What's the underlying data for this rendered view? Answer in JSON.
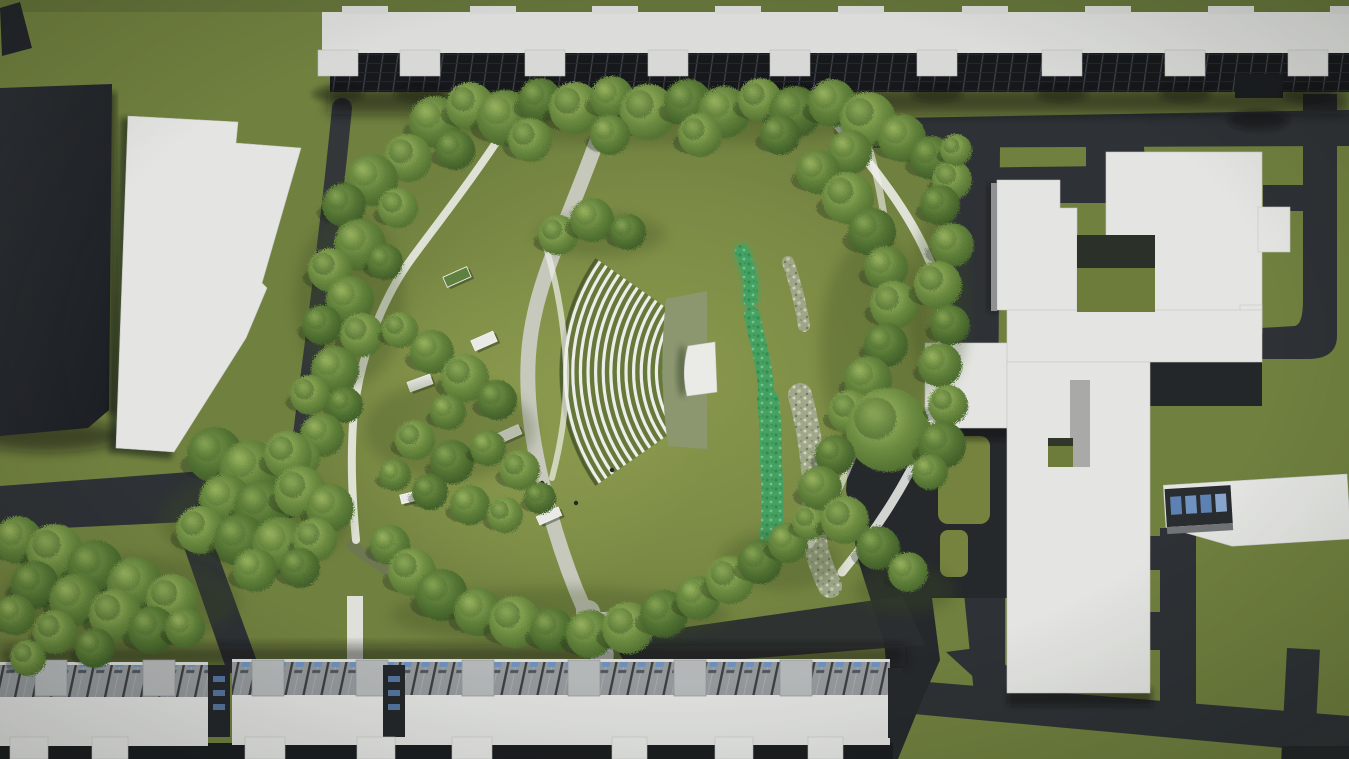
{
  "scene": {
    "title": "Aerial 3D architectural render of a park with amphitheater, winding paths, stream planting and surrounding apartment and school buildings",
    "type": "architectural-site-render",
    "canvas": {
      "width": 1349,
      "height": 759
    },
    "palette": {
      "grass_outer": "#70803f",
      "grass_park": "#7b8a44",
      "grass_bright": "#97a654",
      "road_dark": "#2e3236",
      "road_plaza": "#26292c",
      "road_west": "#33373a",
      "shadow_dark": "#0c0e10",
      "building_white": "#e4e5e2",
      "building_dark": "#24282d",
      "roof_white": "#dcddda",
      "facade_glass": "#16181b",
      "roof_stripe_gray": "#94989b",
      "window_blue": "#5d81b2",
      "tree_light": "#a4bd68",
      "tree_mid": "#95b05c",
      "tree_dark": "#7e9c50",
      "stream_green": "#41a264",
      "gravel_gray": "#a6ac97",
      "path_white": "#f1f2ee",
      "path_concrete": "#cacbc3",
      "apron_gray_green": "#8c9770",
      "stage_white": "#eaebe7",
      "bench_white": "#e9eae6",
      "bench_green": "#5e8140"
    },
    "buildings": {
      "north_block": "long apartment slab with glass facade",
      "northwest_dark": "dark high-rise slab",
      "west_white": "white office slab",
      "east_complex": "white school / institutional complex with courtyards",
      "southeast_low": "low office building with blue glazing",
      "south_row": "apartment row blocks with striped roofs"
    },
    "north_tabs": [
      318,
      400,
      525,
      648,
      770,
      917,
      1042,
      1165,
      1288
    ],
    "north_bumps": [
      342,
      470,
      592,
      715,
      838,
      962,
      1085,
      1208,
      1330
    ],
    "south_row": {
      "boxes": [
        35,
        143,
        252,
        356,
        462,
        568,
        674,
        780
      ],
      "wings": [
        [
          10,
          38
        ],
        [
          92,
          36
        ],
        [
          245,
          40
        ],
        [
          357,
          38
        ],
        [
          452,
          40
        ],
        [
          612,
          35
        ],
        [
          715,
          38
        ],
        [
          808,
          35
        ]
      ],
      "gaps": [
        208,
        383
      ]
    },
    "amphitheater": {
      "cx": 758,
      "cy": 372,
      "inner_radius": 94,
      "rows": 14,
      "row_gap": 7.6,
      "angle_start": 145,
      "angle_end": 215,
      "bench_color": "#edeeea",
      "lawn_color": "#66793b"
    },
    "trees": [
      [
        435,
        122,
        26,
        0
      ],
      [
        470,
        106,
        24,
        1
      ],
      [
        505,
        118,
        28,
        0
      ],
      [
        540,
        100,
        22,
        2
      ],
      [
        575,
        108,
        26,
        1
      ],
      [
        612,
        98,
        22,
        0
      ],
      [
        648,
        112,
        28,
        1
      ],
      [
        688,
        103,
        24,
        2
      ],
      [
        724,
        112,
        26,
        0
      ],
      [
        760,
        100,
        22,
        1
      ],
      [
        795,
        112,
        26,
        2
      ],
      [
        832,
        103,
        24,
        0
      ],
      [
        868,
        120,
        28,
        1
      ],
      [
        902,
        138,
        24,
        0
      ],
      [
        932,
        158,
        22,
        2
      ],
      [
        952,
        180,
        20,
        1
      ],
      [
        455,
        150,
        20,
        2
      ],
      [
        530,
        140,
        22,
        1
      ],
      [
        610,
        135,
        20,
        0
      ],
      [
        700,
        135,
        22,
        1
      ],
      [
        780,
        135,
        20,
        2
      ],
      [
        850,
        152,
        22,
        0
      ],
      [
        408,
        158,
        24,
        1
      ],
      [
        372,
        180,
        26,
        0
      ],
      [
        344,
        205,
        22,
        2
      ],
      [
        398,
        208,
        20,
        1
      ],
      [
        360,
        245,
        26,
        0
      ],
      [
        330,
        270,
        22,
        1
      ],
      [
        385,
        262,
        18,
        2
      ],
      [
        350,
        300,
        24,
        0
      ],
      [
        322,
        325,
        20,
        2
      ],
      [
        362,
        335,
        22,
        1
      ],
      [
        335,
        370,
        24,
        0
      ],
      [
        310,
        395,
        20,
        1
      ],
      [
        345,
        405,
        18,
        2
      ],
      [
        322,
        435,
        22,
        0
      ],
      [
        300,
        458,
        20,
        1
      ],
      [
        215,
        455,
        28,
        2
      ],
      [
        250,
        470,
        30,
        0
      ],
      [
        288,
        455,
        24,
        1
      ],
      [
        225,
        500,
        26,
        0
      ],
      [
        262,
        508,
        28,
        2
      ],
      [
        300,
        492,
        26,
        1
      ],
      [
        330,
        508,
        24,
        0
      ],
      [
        200,
        530,
        24,
        1
      ],
      [
        240,
        540,
        26,
        2
      ],
      [
        280,
        545,
        28,
        0
      ],
      [
        315,
        540,
        22,
        1
      ],
      [
        255,
        570,
        22,
        0
      ],
      [
        300,
        568,
        20,
        2
      ],
      [
        400,
        330,
        18,
        1
      ],
      [
        432,
        352,
        22,
        0
      ],
      [
        465,
        378,
        24,
        1
      ],
      [
        497,
        400,
        20,
        2
      ],
      [
        448,
        412,
        18,
        0
      ],
      [
        415,
        440,
        20,
        1
      ],
      [
        452,
        462,
        22,
        2
      ],
      [
        488,
        448,
        18,
        0
      ],
      [
        520,
        470,
        20,
        1
      ],
      [
        430,
        492,
        18,
        2
      ],
      [
        470,
        505,
        20,
        0
      ],
      [
        505,
        515,
        18,
        1
      ],
      [
        540,
        498,
        16,
        2
      ],
      [
        395,
        475,
        16,
        0
      ],
      [
        558,
        235,
        20,
        1
      ],
      [
        592,
        220,
        22,
        0
      ],
      [
        628,
        232,
        18,
        2
      ],
      [
        390,
        545,
        20,
        0
      ],
      [
        412,
        572,
        24,
        1
      ],
      [
        442,
        595,
        26,
        2
      ],
      [
        478,
        612,
        24,
        0
      ],
      [
        515,
        622,
        26,
        1
      ],
      [
        552,
        630,
        22,
        2
      ],
      [
        590,
        634,
        24,
        0
      ],
      [
        628,
        628,
        26,
        1
      ],
      [
        664,
        614,
        24,
        2
      ],
      [
        698,
        598,
        22,
        0
      ],
      [
        730,
        580,
        24,
        1
      ],
      [
        760,
        562,
        22,
        2
      ],
      [
        788,
        543,
        20,
        0
      ],
      [
        810,
        522,
        18,
        1
      ],
      [
        818,
        172,
        22,
        0
      ],
      [
        848,
        198,
        26,
        1
      ],
      [
        872,
        232,
        24,
        2
      ],
      [
        886,
        268,
        22,
        0
      ],
      [
        894,
        305,
        24,
        1
      ],
      [
        886,
        345,
        22,
        2
      ],
      [
        868,
        380,
        24,
        0
      ],
      [
        850,
        412,
        22,
        1
      ],
      [
        888,
        430,
        42,
        1
      ],
      [
        835,
        455,
        20,
        2
      ],
      [
        820,
        488,
        22,
        0
      ],
      [
        845,
        520,
        24,
        1
      ],
      [
        878,
        548,
        22,
        2
      ],
      [
        908,
        572,
        20,
        0
      ],
      [
        940,
        205,
        20,
        2
      ],
      [
        952,
        245,
        22,
        0
      ],
      [
        938,
        285,
        24,
        1
      ],
      [
        950,
        325,
        20,
        2
      ],
      [
        940,
        365,
        22,
        0
      ],
      [
        948,
        405,
        20,
        1
      ],
      [
        942,
        445,
        24,
        2
      ],
      [
        930,
        472,
        18,
        0
      ],
      [
        956,
        150,
        16,
        1
      ],
      [
        18,
        540,
        24,
        0
      ],
      [
        55,
        552,
        28,
        1
      ],
      [
        95,
        568,
        28,
        2
      ],
      [
        135,
        585,
        28,
        0
      ],
      [
        172,
        600,
        26,
        1
      ],
      [
        35,
        585,
        24,
        2
      ],
      [
        75,
        600,
        26,
        0
      ],
      [
        115,
        615,
        26,
        1
      ],
      [
        152,
        630,
        24,
        2
      ],
      [
        15,
        615,
        20,
        0
      ],
      [
        55,
        632,
        22,
        1
      ],
      [
        95,
        648,
        20,
        2
      ],
      [
        28,
        658,
        18,
        1
      ],
      [
        185,
        628,
        20,
        0
      ]
    ],
    "benches": [
      {
        "x": 457,
        "y": 277,
        "w": 26,
        "h": 11,
        "rot": -24,
        "top": "green"
      },
      {
        "x": 484,
        "y": 341,
        "w": 24,
        "h": 11,
        "rot": -24,
        "top": "white"
      },
      {
        "x": 420,
        "y": 383,
        "w": 24,
        "h": 10,
        "rot": -20,
        "top": "white"
      },
      {
        "x": 509,
        "y": 434,
        "w": 24,
        "h": 10,
        "rot": -24,
        "top": "white"
      },
      {
        "x": 411,
        "y": 497,
        "w": 21,
        "h": 9,
        "rot": -14,
        "top": "white"
      },
      {
        "x": 549,
        "y": 516,
        "w": 24,
        "h": 9,
        "rot": -24,
        "top": "white"
      }
    ],
    "people": [
      [
        542,
        483
      ],
      [
        576,
        503
      ],
      [
        612,
        470
      ]
    ],
    "lawn_shadows": [
      [
        255,
        520,
        95,
        48
      ],
      [
        120,
        600,
        120,
        45
      ],
      [
        350,
        300,
        55,
        85
      ],
      [
        650,
        118,
        240,
        26
      ],
      [
        875,
        350,
        55,
        115
      ],
      [
        560,
        615,
        170,
        28
      ],
      [
        450,
        430,
        85,
        50
      ],
      [
        600,
        235,
        65,
        22
      ],
      [
        780,
        560,
        60,
        30
      ],
      [
        940,
        300,
        30,
        90
      ],
      [
        905,
        590,
        50,
        25
      ]
    ]
  }
}
